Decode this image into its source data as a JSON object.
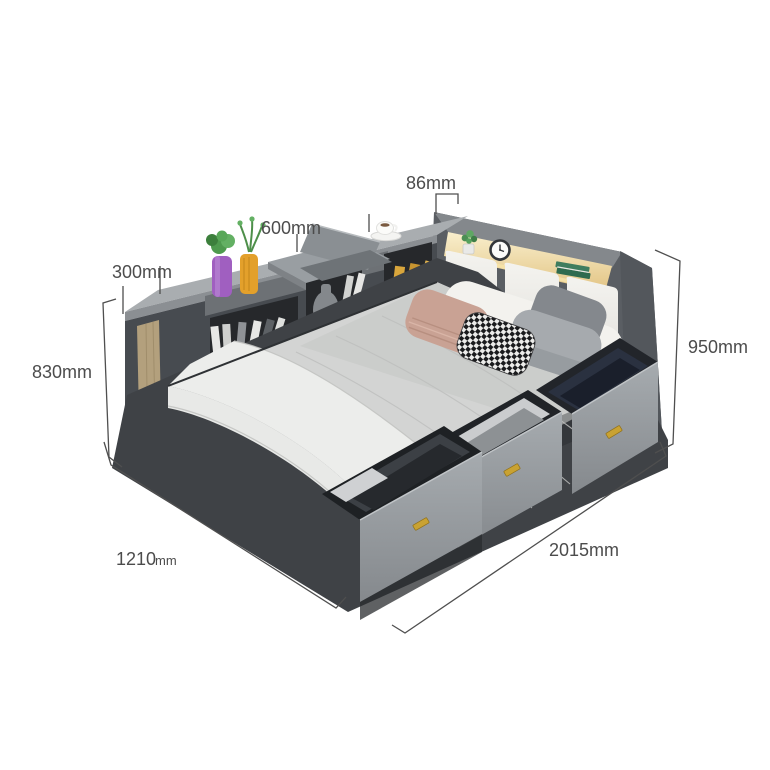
{
  "meta": {
    "description": "Storage bed with bookshelf side cabinet and lighted headboard — dimension diagram"
  },
  "dimensions": {
    "headboard_top": "86mm",
    "tray": "600mm",
    "shelf_depth": "300mm",
    "side_height": "830mm",
    "headboard_height": "950mm",
    "width_value": "1210",
    "width_unit": "mm",
    "length": "2015mm"
  },
  "colors": {
    "handle_gold": "#c9a232",
    "led_warm": "#f7e3a8",
    "frame_dark": "#45494e",
    "mattress_light": "#d3d4d3",
    "dimension_line": "#4f4f4f"
  }
}
